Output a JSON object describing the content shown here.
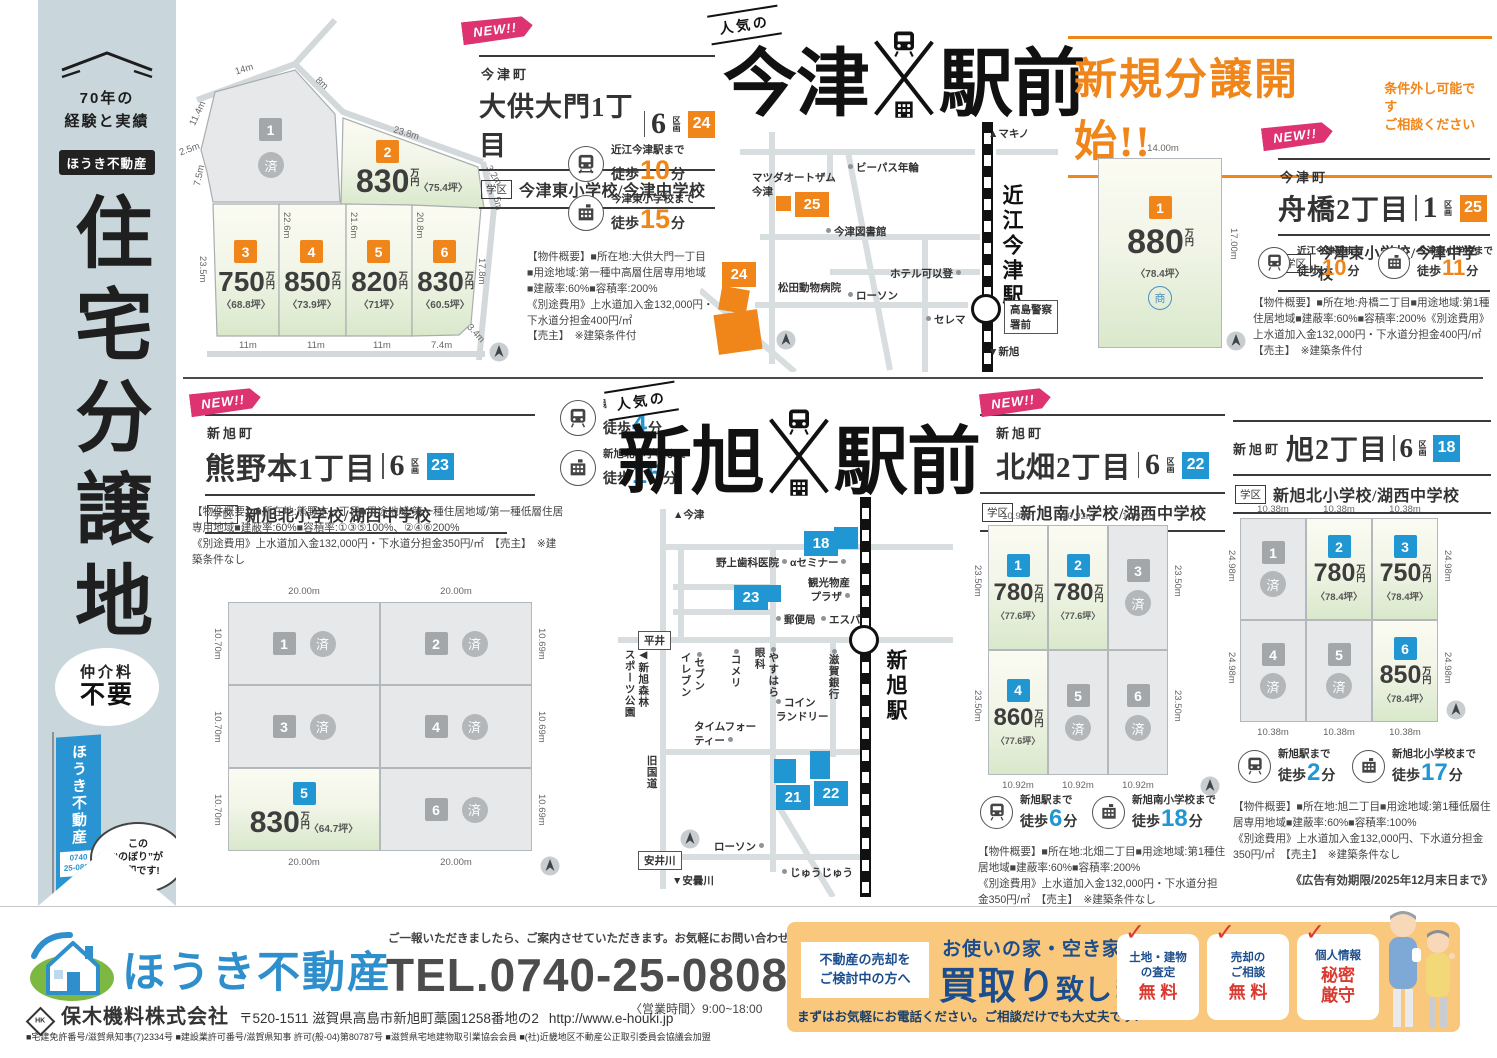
{
  "units": {
    "manyen": "万円",
    "walk": "徒歩",
    "min_unit": "分"
  },
  "marks": {
    "new": "NEW!!",
    "sold": "済",
    "sho": "商"
  },
  "sidebar": {
    "exp": "70年の\n経験と実績",
    "brand": "ほうき不動産",
    "title": "住宅分譲地",
    "fee1": "仲介料",
    "fee2": "不要",
    "flag_brand": "ほうき不動産",
    "flag_tel": "0740\n25-0808",
    "bubble": "この\n“のぼり”が\n目印です!"
  },
  "banner": {
    "title": "新規分譲開始!!",
    "note": "条件外し可能です\nご相談ください"
  },
  "hl_imazu": {
    "tag": "人気の",
    "left": "今津",
    "right": "駅前"
  },
  "hl_shin": {
    "tag": "人気の",
    "left": "新旭",
    "right": "駅前"
  },
  "site24": {
    "town": "今津町",
    "name": "大供大門1丁目",
    "count": "6",
    "count_unit": "区画",
    "badge": "24",
    "school_tag": "学区",
    "school": "今津東小学校/今津中学校",
    "access1": {
      "dest": "近江今津駅まで",
      "min": "10"
    },
    "access2": {
      "dest": "今津東小学校まで",
      "min": "15"
    },
    "overview": "【物件概要】■所在地:大供大門一丁目\n■用途地域:第一種中高層住居専用地域\n■建蔽率:60%■容積率:200%\n《別途費用》上水道加入金132,000円・\n下水道分担金400円/㎡\n【売主】　※建築条件付",
    "lots": [
      {
        "n": "1"
      },
      {
        "n": "2",
        "price": "830",
        "tsubo": "〈75.4坪〉"
      },
      {
        "n": "3",
        "price": "750",
        "tsubo": "〈68.8坪〉"
      },
      {
        "n": "4",
        "price": "850",
        "tsubo": "〈73.9坪〉"
      },
      {
        "n": "5",
        "price": "820",
        "tsubo": "〈71坪〉"
      },
      {
        "n": "6",
        "price": "830",
        "tsubo": "〈60.5坪〉"
      }
    ],
    "dims": [
      "14m",
      "8m",
      "11.4m",
      "2.5m",
      "7.5m",
      "23.8m",
      "3.2m",
      "5m",
      "22.6m",
      "21.6m",
      "20.8m",
      "23.5m",
      "17.8m",
      "11m",
      "11m",
      "11m",
      "7.4m",
      "3.4m"
    ]
  },
  "site25": {
    "town": "今津町",
    "name": "舟橋2丁目",
    "count": "1",
    "count_unit": "区画",
    "badge": "25",
    "school_tag": "学区",
    "school": "今津東小学校/今津中学校",
    "access1": {
      "dest": "近江今津駅まで",
      "min": "10"
    },
    "access2": {
      "dest": "今津東小学校まで",
      "min": "11"
    },
    "overview": "【物件概要】■所在地:舟橋二丁目■用途地域:第1種住居地域■建蔽率:60%■容積率:200%《別途費用》上水道加入金132,000円・下水道分担金400円/㎡　【売主】　※建築条件付",
    "lot": {
      "n": "1",
      "price": "880",
      "tsubo": "〈78.4坪〉"
    },
    "dims": [
      "14.00m",
      "17.00m"
    ]
  },
  "site23": {
    "town": "新旭町",
    "name": "熊野本1丁目",
    "count": "6",
    "count_unit": "区画",
    "badge": "23",
    "school_tag": "学区",
    "school": "新旭北小学校/湖西中学校",
    "access1": {
      "dest": "新旭駅まで",
      "min": "4"
    },
    "access2": {
      "dest": "新旭北小学校まで",
      "min": "15"
    },
    "overview": "【物件概要】■所在地:熊野本一丁目■用途地域:第一種住居地域/第一種低層住居専用地域■建蔽率:60%■容積率:①③⑤100%、②④⑥200%\n《別途費用》上水道加入金132,000円・下水道分担金350円/㎡　【売主】　※建築条件なし",
    "lots": [
      {
        "n": "1"
      },
      {
        "n": "2"
      },
      {
        "n": "3"
      },
      {
        "n": "4"
      },
      {
        "n": "5",
        "price": "830",
        "tsubo": "〈64.7坪〉"
      },
      {
        "n": "6"
      }
    ],
    "dims_top": [
      "20.00m",
      "20.00m"
    ],
    "dims_bottom": [
      "20.00m",
      "20.00m"
    ],
    "dims_left": [
      "10.70m",
      "10.70m",
      "10.70m"
    ],
    "dims_right": [
      "10.69m",
      "10.69m",
      "10.69m"
    ]
  },
  "site22": {
    "town": "新旭町",
    "name": "北畑2丁目",
    "count": "6",
    "count_unit": "区画",
    "badge": "22",
    "school_tag": "学区",
    "school": "新旭南小学校/湖西中学校",
    "access1": {
      "dest": "新旭駅まで",
      "min": "6"
    },
    "access2": {
      "dest": "新旭南小学校まで",
      "min": "18"
    },
    "overview": "【物件概要】■所在地:北畑二丁目■用途地域:第1種住居地域■建蔽率:60%■容積率:200%\n《別途費用》上水道加入金132,000円・下水道分担金350円/㎡　【売主】　※建築条件なし",
    "lots": [
      {
        "n": "1",
        "price": "780",
        "tsubo": "〈77.6坪〉"
      },
      {
        "n": "2",
        "price": "780",
        "tsubo": "〈77.6坪〉"
      },
      {
        "n": "3"
      },
      {
        "n": "4",
        "price": "860",
        "tsubo": "〈77.6坪〉"
      },
      {
        "n": "5"
      },
      {
        "n": "6"
      }
    ],
    "dims_top": [
      "10.92m",
      "10.92m",
      "10.92m"
    ],
    "dims_bottom": [
      "10.92m",
      "10.92m",
      "10.92m"
    ],
    "dims_left": [
      "23.50m",
      "23.50m"
    ],
    "dims_right": [
      "23.50m",
      "23.50m"
    ]
  },
  "site18": {
    "town": "新旭町",
    "name": "旭2丁目",
    "count": "6",
    "count_unit": "区画",
    "badge": "18",
    "school_tag": "学区",
    "school": "新旭北小学校/湖西中学校",
    "access1": {
      "dest": "新旭駅まで",
      "min": "2"
    },
    "access2": {
      "dest": "新旭北小学校まで",
      "min": "17"
    },
    "overview": "【物件概要】■所在地:旭二丁目■用途地域:第1種低層住居専用地域■建蔽率:60%■容積率:100%\n《別途費用》上水道加入金132,000円、下水道分担金350円/㎡　【売主】　※建築条件なし",
    "validity": "《広告有効期限/2025年12月末日まで》",
    "lots": [
      {
        "n": "1"
      },
      {
        "n": "2",
        "price": "780",
        "tsubo": "〈78.4坪〉"
      },
      {
        "n": "3",
        "price": "750",
        "tsubo": "〈78.4坪〉"
      },
      {
        "n": "4"
      },
      {
        "n": "5"
      },
      {
        "n": "6",
        "price": "850",
        "tsubo": "〈78.4坪〉"
      }
    ],
    "dims_top": [
      "10.38m",
      "10.38m",
      "10.38m"
    ],
    "dims_bottom": [
      "10.38m",
      "10.38m",
      "10.38m"
    ],
    "dims_left": [
      "24.98m",
      "24.98m"
    ],
    "dims_right": [
      "24.98m",
      "24.98m"
    ]
  },
  "mi": {
    "dir_top": "▲マキノ",
    "dir_bottom": "▼新旭",
    "station": "近江今津駅",
    "police": "高島警察署前",
    "mazda": "マツダオートザム\n今津",
    "bypass": "ビーパス年輪",
    "badge25": "25",
    "badge24": "24",
    "library": "今津図書館",
    "hotel": "ホテル可以登",
    "vet": "松田動物病院",
    "lawson": "ローソン",
    "serema": "セレマ"
  },
  "ms": {
    "dir_top": "▲今津",
    "dir_bottom": "▼安曇川",
    "station": "新旭駅",
    "badge18": "18",
    "badge21": "21",
    "badge22": "22",
    "badge23": "23",
    "dental": "野上歯科医院",
    "seminar": "αセミナー",
    "plaza": "観光物産\nプラザ",
    "post": "郵便局",
    "espa": "エスパ",
    "hirai": "平井",
    "park": "◀新旭森林\nスポーツ公園",
    "seven": "セブン\nイレブン",
    "komeri": "コメリ",
    "yasuhara": "やすはら\n眼科",
    "shiga_bank": "滋賀銀行",
    "coin": "コイン\nランドリー",
    "tea": "タイムフォー\nティー",
    "old_road": "旧国道",
    "lawson": "ローソン",
    "yasui": "安井川",
    "juju": "じゅうじゅう"
  },
  "footer": {
    "message": "ご一報いただきましたら、ご案内させていただきます。お気軽にお問い合わせください。",
    "brand": "ほうき不動産",
    "tel": "TEL.0740-25-0808",
    "hours": "〈営業時間〉9:00~18:00",
    "hk": "HK",
    "company": "保木機料株式会社",
    "address": "〒520-1511 滋賀県高島市新旭町藁園1258番地の2",
    "url": "http://www.e-houki.jp",
    "license": "■宅建免許番号/滋賀県知事(7)2334号 ■建設業許可番号/滋賀県知事 許可(般-04)第80787号 ■滋賀県宅地建物取引業協会会員 ■(社)近畿地区不動産公正取引委員会協議会加盟",
    "promo": {
      "target": "不動産の売却を\nご検討中の方へ",
      "head_small": "お使いの家・空き家・土地",
      "big1": "買取り",
      "big2": "致します!",
      "note": "まずはお気軽にお電話ください。ご相談だけでも大丈夫です!",
      "cards": [
        {
          "label": "土地・建物\nの査定",
          "value": "無 料"
        },
        {
          "label": "売却の\nご相談",
          "value": "無 料"
        },
        {
          "label": "個人情報",
          "value": "秘密\n厳守"
        }
      ]
    }
  }
}
